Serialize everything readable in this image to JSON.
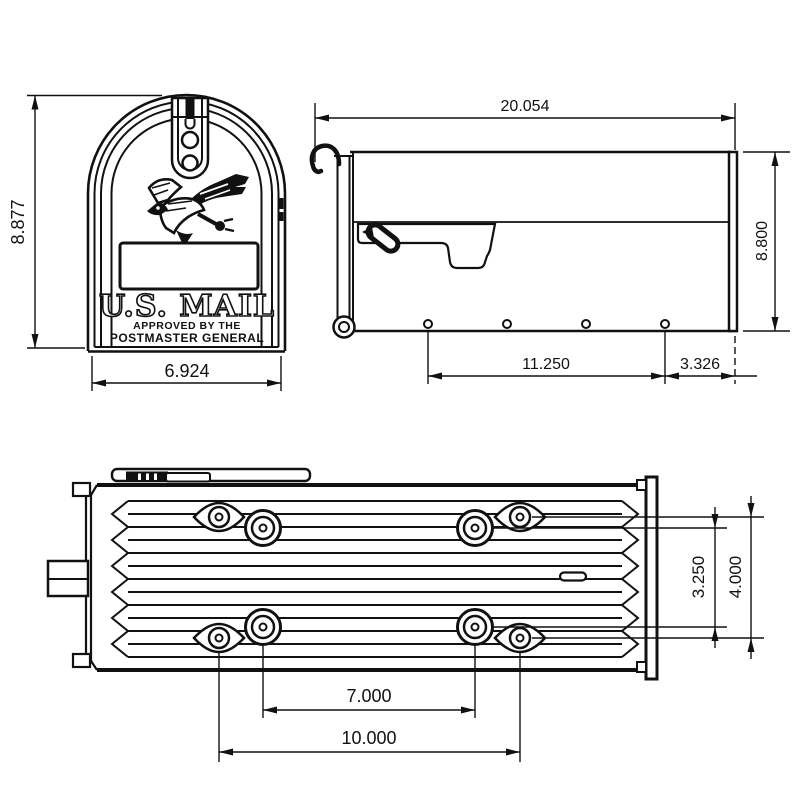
{
  "page": {
    "background": "#ffffff",
    "ink": "#111111",
    "description": "Technical dimension drawing of a U.S. Mail post-mount mailbox: front view, side view and bottom mounting-hole view"
  },
  "views": {
    "front": {
      "name": "front-view",
      "emblem": {
        "us_mail": "U.S. MAIL",
        "approved_line1": "APPROVED BY THE",
        "approved_line2": "POSTMASTER GENERAL"
      },
      "dimensions": {
        "height": "8.877",
        "width": "6.924"
      }
    },
    "side": {
      "name": "side-view",
      "dimensions": {
        "length": "20.054",
        "height": "8.800",
        "hole_span": "11.250",
        "rear_offset": "3.326"
      }
    },
    "bottom": {
      "name": "bottom-view",
      "dimensions": {
        "inner_hole_pitch": "7.000",
        "outer_hole_pitch": "10.000",
        "inner_row_pitch": "3.250",
        "outer_row_pitch": "4.000"
      }
    }
  }
}
